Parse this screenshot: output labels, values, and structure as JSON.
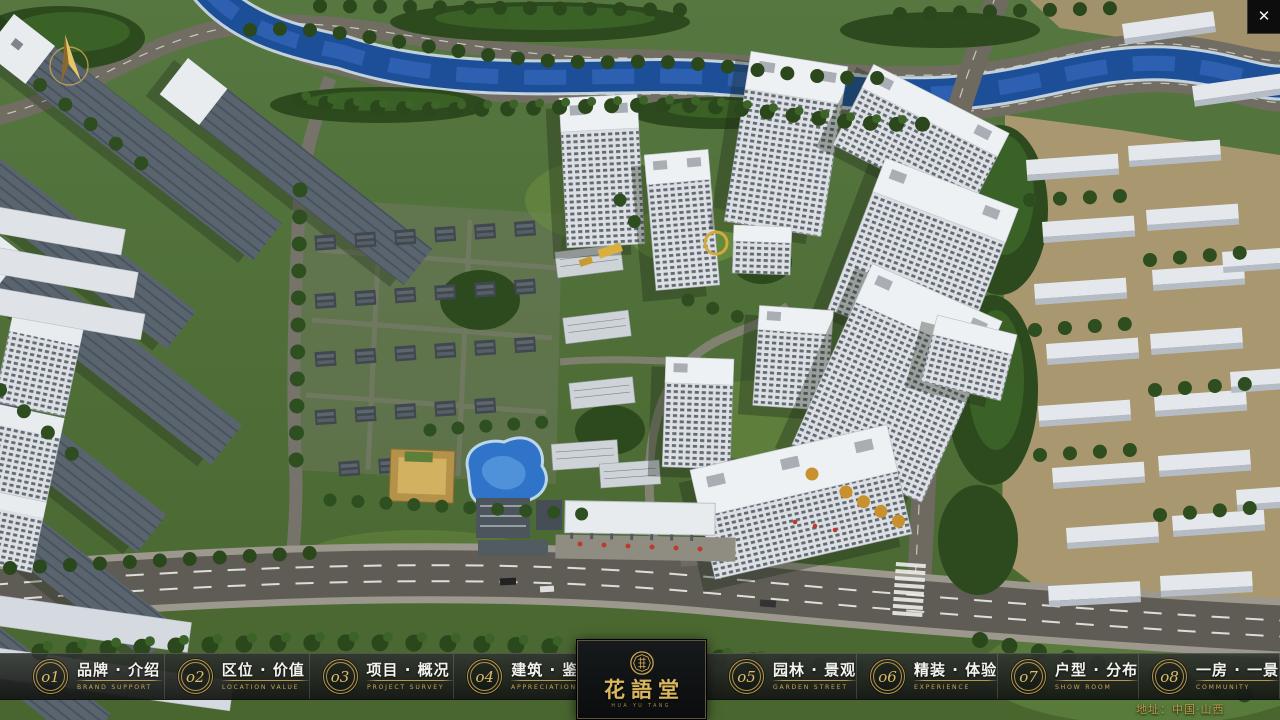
{
  "window": {
    "close_icon": "✕"
  },
  "nav": {
    "items": [
      {
        "num": "o1",
        "zh": "品牌 · 介绍",
        "en": "BRAND SUPPORT"
      },
      {
        "num": "o2",
        "zh": "区位 · 价值",
        "en": "LOCATION VALUE"
      },
      {
        "num": "o3",
        "zh": "项目 · 概况",
        "en": "PROJECT SURVEY"
      },
      {
        "num": "o4",
        "zh": "建筑 · 鉴赏",
        "en": "APPRECIATION"
      },
      {
        "num": "o5",
        "zh": "园林 · 景观",
        "en": "GARDEN STREET"
      },
      {
        "num": "o6",
        "zh": "精装 · 体验",
        "en": "EXPERIENCE"
      },
      {
        "num": "o7",
        "zh": "户型 · 分布",
        "en": "SHOW ROOM"
      },
      {
        "num": "o8",
        "zh": "一房 · 一景",
        "en": "COMMUNITY"
      }
    ]
  },
  "logo": {
    "title": "花語堂",
    "subtitle": "HUA YU TANG"
  },
  "footer": {
    "address": "地址：中国·山西"
  },
  "colors": {
    "gold": "#c9a452",
    "bar_bg": "#23261f",
    "river": "#1d4f99"
  }
}
